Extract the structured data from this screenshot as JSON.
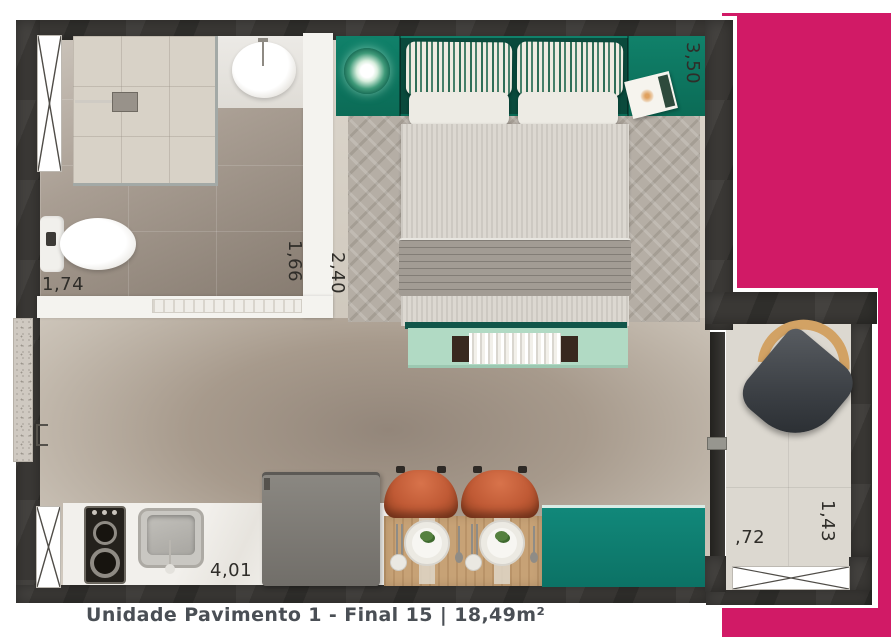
{
  "caption": {
    "text": "Unidade Pavimento 1 - Final 15 | 18,49m²"
  },
  "dimensions": {
    "bathroom_width": "1,74",
    "bathroom_depth": "1,66",
    "bedroom_width": "2,40",
    "bedroom_depth": "3,50",
    "kitchen_length": "4,01",
    "balcony_width": ",72",
    "balcony_depth": "1,43"
  },
  "colors": {
    "accent_pink": "#d11a66",
    "wall_dark": "#3b3936",
    "headboard_green": "#0d7a64",
    "cabinet_teal": "#0f8173",
    "bench_mint": "#b1dac4",
    "chair_orange": "#c05a35"
  }
}
